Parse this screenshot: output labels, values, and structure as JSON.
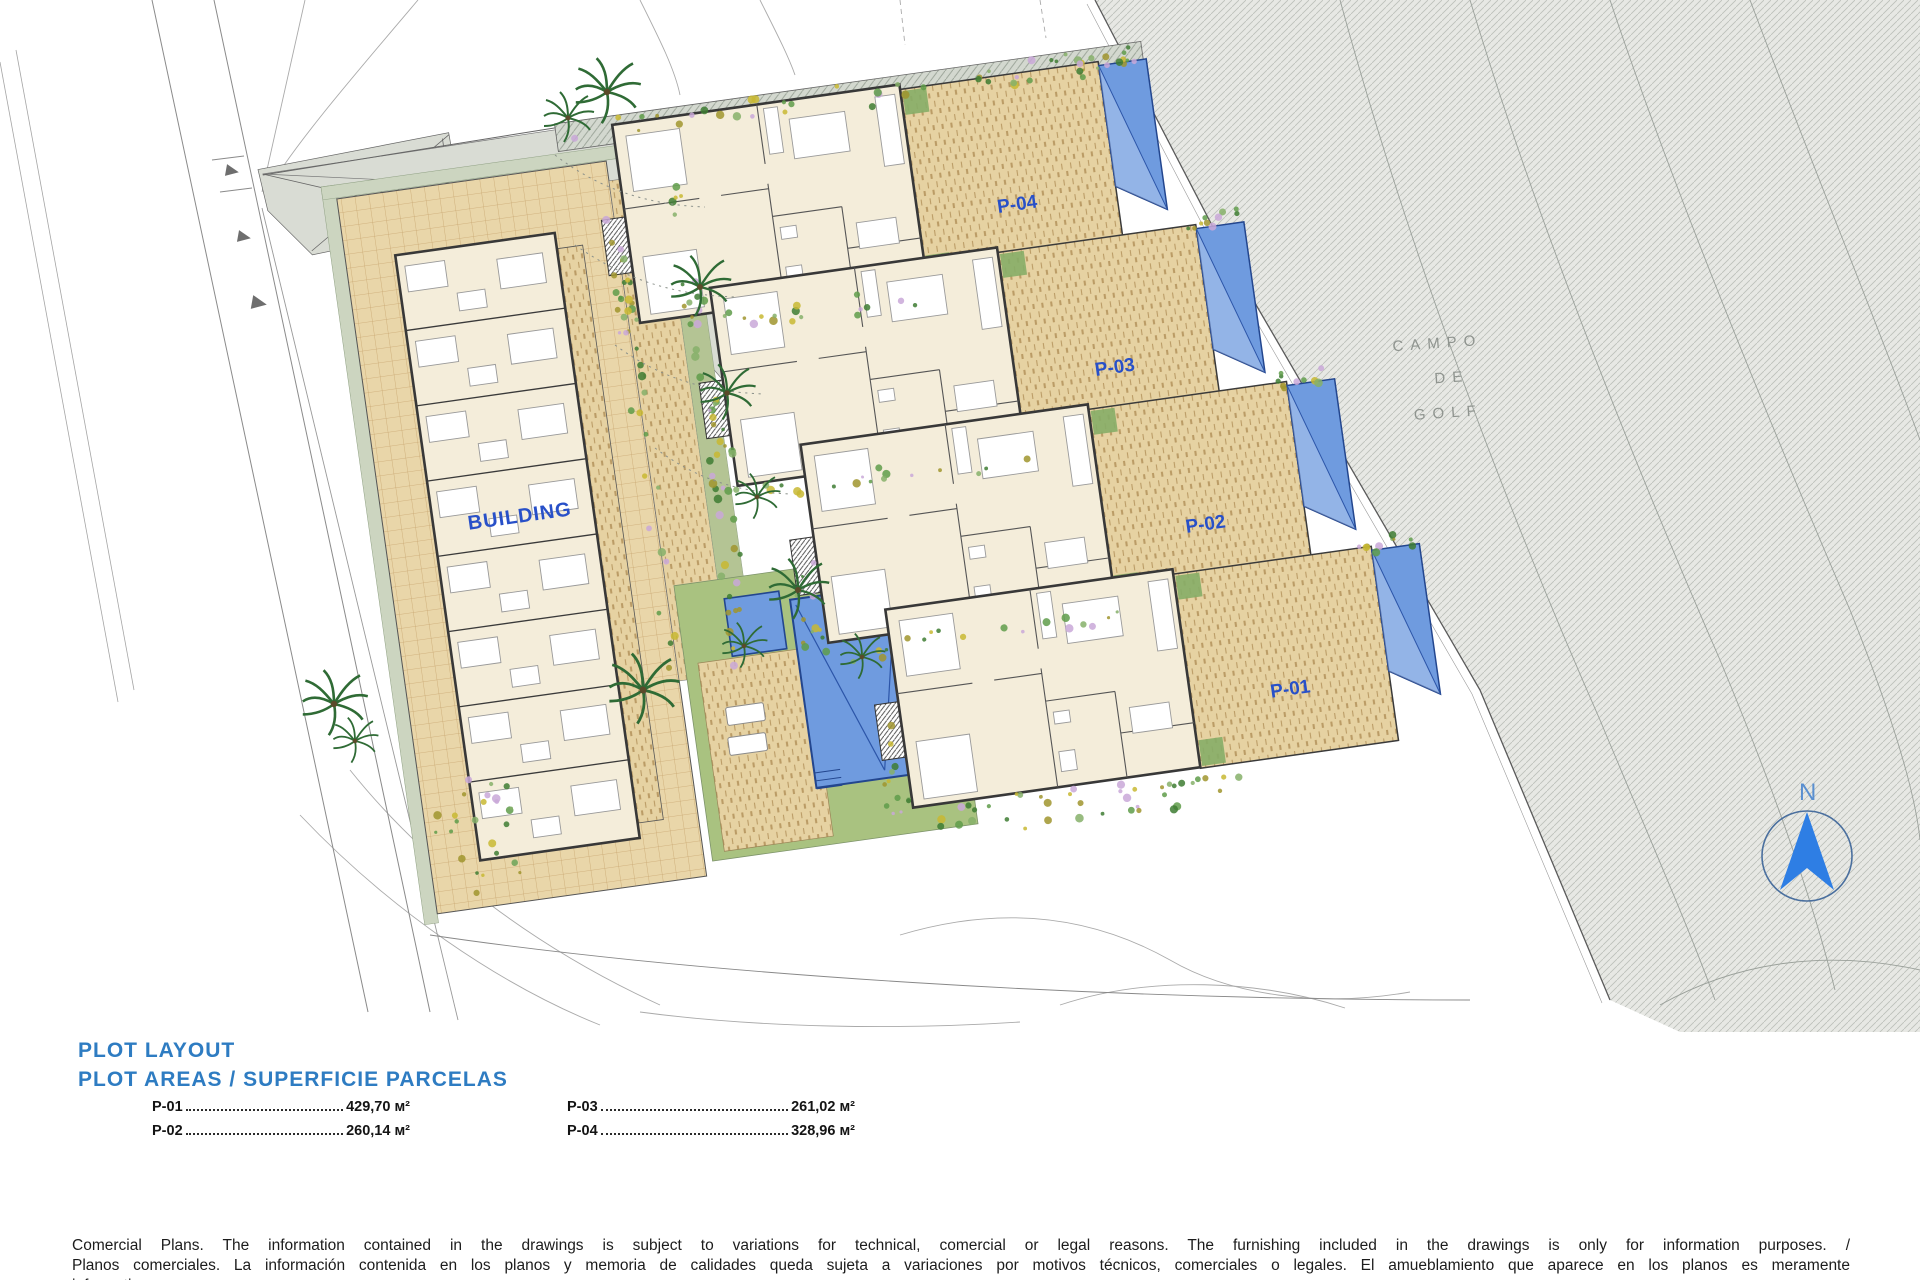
{
  "plan": {
    "building_label": "BUILDING",
    "plot_labels": [
      "P-04",
      "P-03",
      "P-02",
      "P-01"
    ],
    "golf_label": {
      "line1": "CAMPO",
      "line2": "DE",
      "line3": "GOLF"
    },
    "compass_n": "N"
  },
  "legend": {
    "title_line1": "PLOT LAYOUT",
    "title_line2": "PLOT AREAS / SUPERFICIE PARCELAS",
    "areas": [
      {
        "plot": "P-01",
        "value": "429,70 м²"
      },
      {
        "plot": "P-02",
        "value": "260,14 м²"
      },
      {
        "plot": "P-03",
        "value": "261,02 м²"
      },
      {
        "plot": "P-04",
        "value": "328,96 м²"
      }
    ]
  },
  "disclaimer": {
    "lines": [
      "Comercial Plans. The information contained in the drawings is subject to variations for technical, comercial or legal reasons. The furnishing included in the drawings is only for information purposes. /",
      "Planos comerciales. La información contenida en los planos y memoria de calidades queda sujeta a variaciones por motivos técnicos, comerciales o legales. El amueblamiento que aparece en los planos es meramente",
      "informativo."
    ]
  },
  "colors": {
    "heading_blue": "#2e7cc2",
    "plan_label_blue": "#2850c8",
    "pool_blue": "#6f9bdf",
    "terrace_tan": "#e7d3a6",
    "lawn_green": "#a9c280",
    "road_gray": "#d9dcd4",
    "golf_gray": "#e7e8e4",
    "compass_blue": "#2e7ee4"
  }
}
